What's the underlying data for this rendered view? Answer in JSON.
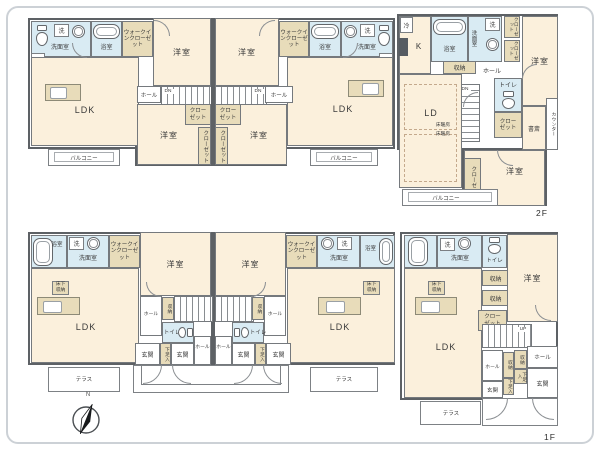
{
  "labels": {
    "ldk": "LDK",
    "ld": "LD",
    "k": "K",
    "bedroom": "洋室",
    "washroom": "洗面室",
    "bath": "浴室",
    "toilet": "トイレ",
    "hall": "ホール",
    "closet": "クローゼット",
    "wic": "ウォークインクローゼット",
    "storage": "収納",
    "shoebox": "下足入",
    "entrance": "玄関",
    "balcony": "バルコニー",
    "terrace": "テラス",
    "study": "書斎",
    "counter": "カウンター",
    "floor_heating": "床暖房",
    "underfloor_storage": "床下収納",
    "fridge": "冷",
    "washer": "洗",
    "down": "DN",
    "up": "UP",
    "floor2": "2F",
    "floor1": "1F",
    "north": "N"
  },
  "colors": {
    "floor": "#fbf0dc",
    "wet": "#d9ebf3",
    "closet": "#e8dcba",
    "wall": "#5d6165"
  }
}
